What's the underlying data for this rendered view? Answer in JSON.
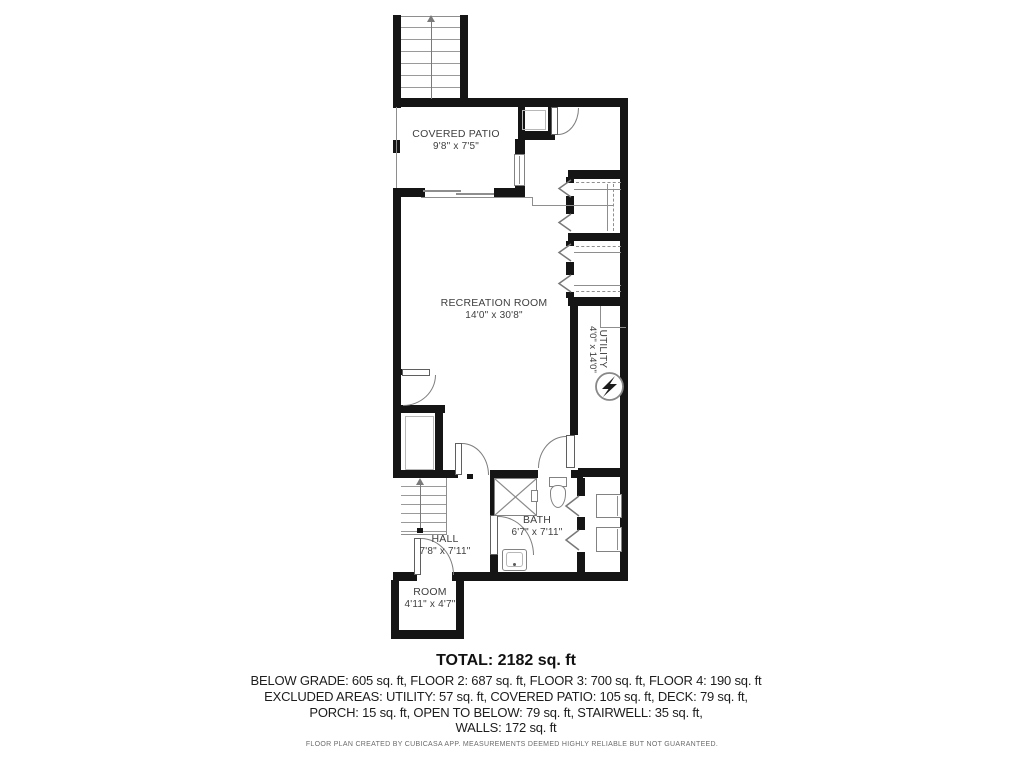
{
  "title": "Floor plan - below grade level",
  "rooms": {
    "covered_patio": {
      "name": "COVERED PATIO",
      "dims": "9'8\" x 7'5\""
    },
    "recreation": {
      "name": "RECREATION ROOM",
      "dims": "14'0\" x 30'8\""
    },
    "utility": {
      "name": "UTILITY",
      "dims": "4'0\" x 14'0\""
    },
    "bath": {
      "name": "BATH",
      "dims": "6'7\" x 7'11\""
    },
    "hall": {
      "name": "HALL",
      "dims": "7'8\" x 7'11\""
    },
    "room": {
      "name": "ROOM",
      "dims": "4'11\" x 4'7\""
    }
  },
  "summary": {
    "total": "TOTAL: 2182 sq. ft",
    "lines": [
      "BELOW GRADE: 605 sq. ft, FLOOR 2: 687 sq. ft, FLOOR 3: 700 sq. ft, FLOOR 4: 190 sq. ft",
      "EXCLUDED AREAS: UTILITY: 57 sq. ft, COVERED PATIO: 105 sq. ft, DECK: 79 sq. ft,",
      "PORCH: 15 sq. ft, OPEN TO BELOW: 79 sq. ft, STAIRWELL: 35 sq. ft,",
      "WALLS: 172 sq. ft"
    ]
  },
  "footer": "FLOOR PLAN CREATED BY CUBICASA APP. MEASUREMENTS DEEMED HIGHLY RELIABLE BUT NOT GUARANTEED.",
  "colors": {
    "wall": "#151515",
    "thin_line": "#8e8e8e",
    "label": "#3f3f3f"
  }
}
